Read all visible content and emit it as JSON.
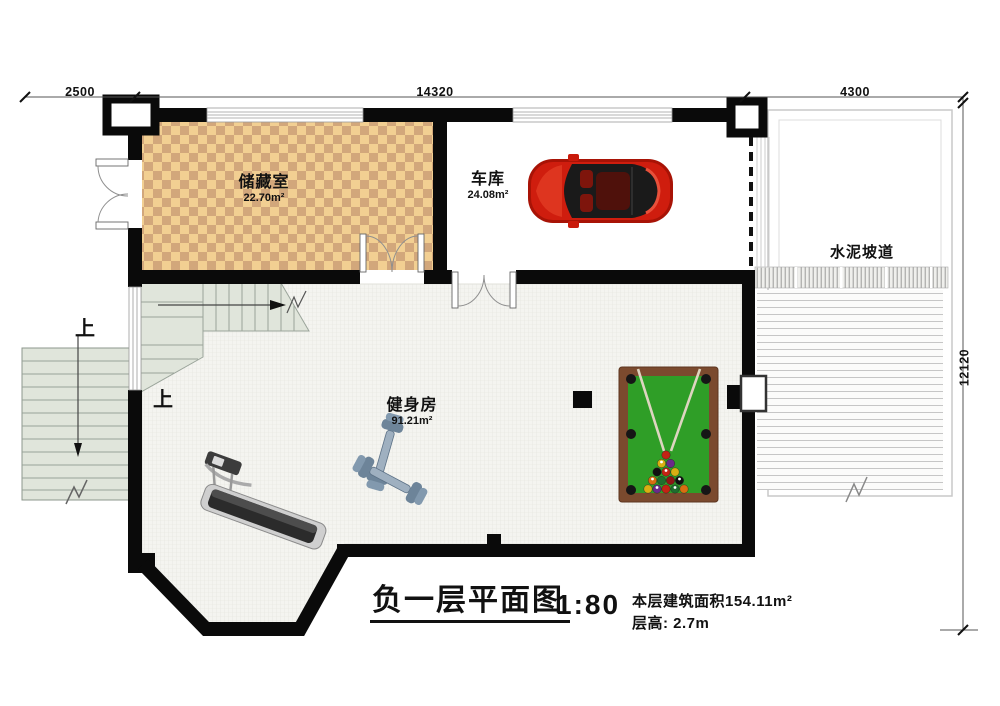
{
  "dimensions": {
    "top_left": "2500",
    "top_middle": "14320",
    "top_right": "4300",
    "right_side": "12120"
  },
  "rooms": [
    {
      "name": "储藏室",
      "area": "22.70m²"
    },
    {
      "name": "车库",
      "area": "24.08m²"
    },
    {
      "name": "健身房",
      "area": "91.21m²"
    }
  ],
  "labels": {
    "ramp": "水泥坡道",
    "stairs_up_outer": "上",
    "stairs_up_inner": "上"
  },
  "title_block": {
    "title": "负一层平面图",
    "scale": "1:80",
    "area_note": "本层建筑面积154.11m²",
    "floor_height_note": "层高: 2.7m"
  },
  "colors": {
    "wall": "#0a0a0a",
    "checker_light": "#f2cf92",
    "checker_dark": "#d2a77b",
    "stairs_fill": "#e0e5db",
    "pool_felt": "#2f9e27",
    "pool_frame": "#7b4a2e",
    "car_body": "#c91a0b",
    "dimension_text": "#111111"
  }
}
